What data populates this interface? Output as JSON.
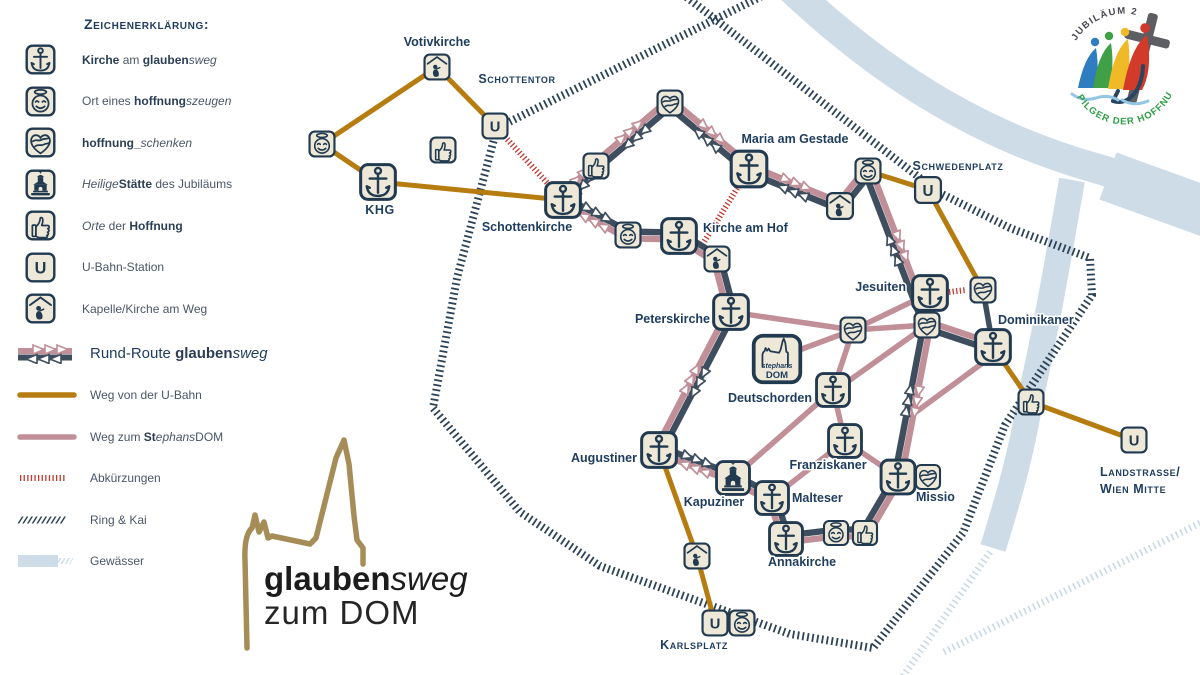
{
  "legend": {
    "title": "Zeichenerklärung:",
    "items": [
      {
        "icon": "church",
        "segs": [
          {
            "t": "Kirche",
            "b": 1
          },
          {
            "t": " am "
          },
          {
            "t": "glauben",
            "b": 1
          },
          {
            "t": "sweg",
            "i": 1
          }
        ]
      },
      {
        "icon": "face",
        "segs": [
          {
            "t": "Ort eines "
          },
          {
            "t": "hoffnung",
            "b": 1
          },
          {
            "t": "szeugen",
            "i": 1
          }
        ]
      },
      {
        "icon": "heart",
        "segs": [
          {
            "t": "hoffnung",
            "b": 1
          },
          {
            "t": "_",
            "b": 1
          },
          {
            "t": "schenken",
            "i": 1
          }
        ]
      },
      {
        "icon": "temple",
        "segs": [
          {
            "t": "Heilige",
            "i": 1
          },
          {
            "t": "Stätte",
            "b": 1
          },
          {
            "t": " des Jubiläums"
          }
        ]
      },
      {
        "icon": "thumb",
        "segs": [
          {
            "t": "Orte",
            "i": 1
          },
          {
            "t": " der "
          },
          {
            "t": "Hoffnung",
            "b": 1
          }
        ]
      },
      {
        "icon": "ubahn",
        "segs": [
          {
            "t": "U-Bahn-Station"
          }
        ]
      },
      {
        "icon": "chapel",
        "segs": [
          {
            "t": "Kapelle/Kirche am Weg"
          }
        ]
      }
    ],
    "routes": [
      {
        "sample": "rundroute",
        "big": true,
        "segs": [
          {
            "t": "Rund-Route "
          },
          {
            "t": "glauben",
            "b": 1
          },
          {
            "t": "sweg",
            "i": 1
          }
        ]
      },
      {
        "sample": "ubahnweg",
        "segs": [
          {
            "t": "Weg von der U-Bahn"
          }
        ]
      },
      {
        "sample": "domweg",
        "segs": [
          {
            "t": "Weg zum "
          },
          {
            "t": "St",
            "b": 1
          },
          {
            "t": "ephans",
            "i": 1
          },
          {
            "t": "DOM"
          }
        ]
      },
      {
        "sample": "abk",
        "segs": [
          {
            "t": "Abkürzungen"
          }
        ]
      },
      {
        "sample": "ring",
        "segs": [
          {
            "t": "Ring & Kai"
          }
        ]
      },
      {
        "sample": "wasser",
        "segs": [
          {
            "t": "Gewässer"
          }
        ]
      }
    ]
  },
  "logo": {
    "bold": "glauben",
    "italic": "sweg",
    "line2": "zum DOM"
  },
  "badge": {
    "top": "JUBILÄUM 2025",
    "bottom": "PILGER DER HOFFNUNG"
  },
  "colors": {
    "navy": "#2c4257",
    "route_navy": "#3f4e5f",
    "pink": "#c08f98",
    "ochre": "#b67c10",
    "red": "#c0392f",
    "cream": "#ede8d8",
    "water": "#cedce7",
    "water_hatch": "#c9d9e5",
    "label": "#1d3c5e",
    "gold": "#a68d58"
  },
  "map": {
    "water_bands": [
      {
        "d": "M 782 -20 C 860 55 960 130 1095 168 C 1150 184 1190 198 1222 208",
        "w": 30
      },
      {
        "d": "M 1108 176 L 1224 218",
        "w": 50
      },
      {
        "d": "M 1072 180 C 1058 260 1046 330 1030 400 C 1021 458 1004 512 993 548",
        "w": 26
      }
    ],
    "water_hatch": [
      {
        "x1": 990,
        "y1": 552,
        "x2": 903,
        "y2": 676
      },
      {
        "x1": 944,
        "y1": 652,
        "x2": 1202,
        "y2": 522
      }
    ],
    "ring": {
      "points": [
        [
          770,
          -8
        ],
        [
          497,
          128
        ],
        [
          457,
          278
        ],
        [
          433,
          408
        ],
        [
          520,
          512
        ],
        [
          600,
          566
        ],
        [
          790,
          634
        ],
        [
          873,
          648
        ],
        [
          963,
          533
        ],
        [
          1005,
          425
        ],
        [
          1092,
          295
        ],
        [
          1090,
          258
        ],
        [
          1010,
          228
        ],
        [
          938,
          192
        ],
        [
          680,
          -8
        ]
      ]
    },
    "brown": [
      {
        "a": [
          322,
          144
        ],
        "b": [
          437,
          67
        ]
      },
      {
        "a": [
          437,
          67
        ],
        "b": [
          495,
          126
        ]
      },
      {
        "a": [
          322,
          144
        ],
        "b": [
          378,
          182
        ]
      },
      {
        "a": [
          378,
          182
        ],
        "b": [
          563,
          200
        ]
      },
      {
        "a": [
          868,
          171
        ],
        "b": [
          928,
          190
        ]
      },
      {
        "a": [
          928,
          190
        ],
        "b": [
          983,
          290
        ]
      },
      {
        "a": [
          993,
          347
        ],
        "b": [
          1031,
          402
        ]
      },
      {
        "a": [
          1031,
          402
        ],
        "b": [
          1134,
          440
        ]
      },
      {
        "a": [
          659,
          450
        ],
        "b": [
          697,
          556
        ]
      },
      {
        "a": [
          697,
          556
        ],
        "b": [
          715,
          623
        ]
      }
    ],
    "dotted": [
      {
        "a": [
          495,
          126
        ],
        "b": [
          563,
          200
        ]
      },
      {
        "a": [
          741,
          182
        ],
        "b": [
          701,
          247
        ]
      },
      {
        "a": [
          949,
          292
        ],
        "b": [
          966,
          290
        ]
      }
    ],
    "pink_paths": [
      {
        "a": [
          731,
          312
        ],
        "b": [
          853,
          330
        ]
      },
      {
        "a": [
          853,
          330
        ],
        "b": [
          802,
          349
        ]
      },
      {
        "a": [
          853,
          330
        ],
        "b": [
          930,
          293
        ]
      },
      {
        "a": [
          853,
          330
        ],
        "b": [
          927,
          325
        ]
      },
      {
        "a": [
          853,
          330
        ],
        "b": [
          833,
          390
        ]
      },
      {
        "a": [
          843,
          385
        ],
        "b": [
          920,
          330
        ]
      },
      {
        "a": [
          833,
          390
        ],
        "b": [
          733,
          478
        ]
      },
      {
        "a": [
          833,
          390
        ],
        "b": [
          845,
          441
        ]
      },
      {
        "a": [
          845,
          441
        ],
        "b": [
          898,
          477
        ]
      },
      {
        "a": [
          772,
          498
        ],
        "b": [
          845,
          441
        ]
      },
      {
        "a": [
          984,
          362
        ],
        "b": [
          916,
          412
        ]
      },
      {
        "a": [
          898,
          477
        ],
        "b": [
          928,
          477
        ]
      }
    ],
    "pairs": [
      {
        "a": [
          563,
          200
        ],
        "b": [
          596,
          166
        ],
        "arrows": true
      },
      {
        "a": [
          596,
          166
        ],
        "b": [
          670,
          103
        ],
        "arrows": true
      },
      {
        "a": [
          670,
          103
        ],
        "b": [
          749,
          169
        ],
        "arrows": true
      },
      {
        "a": [
          749,
          169
        ],
        "b": [
          840,
          206
        ],
        "arrows": true
      },
      {
        "a": [
          840,
          206
        ],
        "b": [
          868,
          171
        ],
        "arrows": false
      },
      {
        "a": [
          868,
          171
        ],
        "b": [
          927,
          325
        ],
        "arrows": true
      },
      {
        "a": [
          927,
          325
        ],
        "b": [
          993,
          347
        ],
        "arrows": false
      },
      {
        "a": [
          927,
          325
        ],
        "b": [
          898,
          477
        ],
        "arrows": true
      },
      {
        "a": [
          898,
          477
        ],
        "b": [
          865,
          533
        ],
        "arrows": false
      },
      {
        "a": [
          865,
          533
        ],
        "b": [
          836,
          533
        ],
        "arrows": false
      },
      {
        "a": [
          836,
          533
        ],
        "b": [
          786,
          539
        ],
        "arrows": false
      },
      {
        "a": [
          786,
          539
        ],
        "b": [
          772,
          498
        ],
        "arrows": false
      },
      {
        "a": [
          772,
          498
        ],
        "b": [
          733,
          478
        ],
        "arrows": false
      },
      {
        "a": [
          733,
          478
        ],
        "b": [
          659,
          450
        ],
        "arrows": true
      },
      {
        "a": [
          659,
          450
        ],
        "b": [
          731,
          312
        ],
        "arrows": true
      },
      {
        "a": [
          731,
          312
        ],
        "b": [
          717,
          259
        ],
        "arrows": false
      },
      {
        "a": [
          717,
          259
        ],
        "b": [
          679,
          236
        ],
        "arrows": false
      },
      {
        "a": [
          679,
          236
        ],
        "b": [
          628,
          235
        ],
        "arrows": false
      },
      {
        "a": [
          628,
          235
        ],
        "b": [
          563,
          200
        ],
        "arrows": true
      }
    ],
    "navy_paths": [
      {
        "a": [
          983,
          290
        ],
        "b": [
          993,
          347
        ]
      }
    ],
    "icons": [
      {
        "t": "face",
        "x": 322,
        "y": 144,
        "s": 28
      },
      {
        "t": "chapel",
        "x": 437,
        "y": 67,
        "s": 28
      },
      {
        "t": "ubahn",
        "x": 495,
        "y": 126,
        "s": 28
      },
      {
        "t": "thumb",
        "x": 443,
        "y": 150,
        "s": 28
      },
      {
        "t": "church",
        "x": 378,
        "y": 182,
        "s": 39
      },
      {
        "t": "church",
        "x": 563,
        "y": 200,
        "s": 39
      },
      {
        "t": "thumb",
        "x": 596,
        "y": 166,
        "s": 28
      },
      {
        "t": "heart",
        "x": 670,
        "y": 103,
        "s": 28
      },
      {
        "t": "church",
        "x": 749,
        "y": 169,
        "s": 40
      },
      {
        "t": "face",
        "x": 628,
        "y": 235,
        "s": 28
      },
      {
        "t": "church",
        "x": 679,
        "y": 236,
        "s": 39
      },
      {
        "t": "chapel",
        "x": 717,
        "y": 259,
        "s": 28
      },
      {
        "t": "face",
        "x": 868,
        "y": 171,
        "s": 28
      },
      {
        "t": "chapel",
        "x": 840,
        "y": 206,
        "s": 29
      },
      {
        "t": "ubahn",
        "x": 928,
        "y": 190,
        "s": 29
      },
      {
        "t": "church",
        "x": 930,
        "y": 293,
        "s": 39
      },
      {
        "t": "heart",
        "x": 983,
        "y": 290,
        "s": 28
      },
      {
        "t": "heart",
        "x": 927,
        "y": 325,
        "s": 28
      },
      {
        "t": "church",
        "x": 993,
        "y": 347,
        "s": 39
      },
      {
        "t": "church",
        "x": 731,
        "y": 312,
        "s": 39
      },
      {
        "t": "heart",
        "x": 853,
        "y": 330,
        "s": 28
      },
      {
        "t": "church",
        "x": 833,
        "y": 390,
        "s": 37
      },
      {
        "t": "church",
        "x": 845,
        "y": 441,
        "s": 37
      },
      {
        "t": "church",
        "x": 659,
        "y": 450,
        "s": 39
      },
      {
        "t": "temple",
        "x": 733,
        "y": 478,
        "s": 37
      },
      {
        "t": "church",
        "x": 772,
        "y": 498,
        "s": 37
      },
      {
        "t": "church",
        "x": 786,
        "y": 539,
        "s": 37
      },
      {
        "t": "face",
        "x": 836,
        "y": 533,
        "s": 27
      },
      {
        "t": "thumb",
        "x": 865,
        "y": 533,
        "s": 27
      },
      {
        "t": "church",
        "x": 898,
        "y": 477,
        "s": 38
      },
      {
        "t": "heart",
        "x": 928,
        "y": 477,
        "s": 27
      },
      {
        "t": "chapel",
        "x": 697,
        "y": 556,
        "s": 28
      },
      {
        "t": "ubahn",
        "x": 715,
        "y": 623,
        "s": 28
      },
      {
        "t": "face",
        "x": 742,
        "y": 623,
        "s": 28
      },
      {
        "t": "thumb",
        "x": 1031,
        "y": 402,
        "s": 28
      },
      {
        "t": "ubahn",
        "x": 1134,
        "y": 440,
        "s": 28
      },
      {
        "t": "dom",
        "x": 777,
        "y": 359,
        "s": 52
      }
    ],
    "labels": [
      {
        "text": "Votivkirche",
        "x": 437,
        "y": 46,
        "kind": "place",
        "anchor": "middle"
      },
      {
        "text": "Schottentor",
        "x": 517,
        "y": 83,
        "kind": "station",
        "anchor": "middle"
      },
      {
        "text": "KHG",
        "x": 380,
        "y": 214,
        "kind": "station",
        "anchor": "middle"
      },
      {
        "text": "Schottenkirche",
        "x": 527,
        "y": 231,
        "kind": "place",
        "anchor": "middle"
      },
      {
        "text": "Maria am Gestade",
        "x": 795,
        "y": 143,
        "kind": "place",
        "anchor": "middle"
      },
      {
        "text": "Schwedenplatz",
        "x": 958,
        "y": 170,
        "kind": "station",
        "anchor": "middle"
      },
      {
        "text": "Kirche am Hof",
        "x": 703,
        "y": 232,
        "kind": "place",
        "anchor": "start"
      },
      {
        "text": "Jesuiten",
        "x": 906,
        "y": 291,
        "kind": "place",
        "anchor": "end"
      },
      {
        "text": "Dominikaner",
        "x": 998,
        "y": 324,
        "kind": "place",
        "anchor": "start"
      },
      {
        "text": "Peterskirche",
        "x": 710,
        "y": 323,
        "kind": "place",
        "anchor": "end"
      },
      {
        "text": "Deutschorden",
        "x": 812,
        "y": 402,
        "kind": "place",
        "anchor": "end"
      },
      {
        "text": "Franziskaner",
        "x": 828,
        "y": 469,
        "kind": "place",
        "anchor": "middle"
      },
      {
        "text": "Augustiner",
        "x": 637,
        "y": 462,
        "kind": "place",
        "anchor": "end"
      },
      {
        "text": "Kapuziner",
        "x": 714,
        "y": 506,
        "kind": "place",
        "anchor": "middle"
      },
      {
        "text": "Malteser",
        "x": 792,
        "y": 502,
        "kind": "place",
        "anchor": "start"
      },
      {
        "text": "Missio",
        "x": 916,
        "y": 501,
        "kind": "place",
        "anchor": "start"
      },
      {
        "text": "Annakirche",
        "x": 802,
        "y": 566,
        "kind": "place",
        "anchor": "middle"
      },
      {
        "text": "Karlsplatz",
        "x": 694,
        "y": 649,
        "kind": "station",
        "anchor": "middle"
      },
      {
        "text": "Landstrasse/",
        "x": 1100,
        "y": 476,
        "kind": "station",
        "anchor": "start"
      },
      {
        "text": "Wien Mitte",
        "x": 1100,
        "y": 493,
        "kind": "station",
        "anchor": "start"
      },
      {
        "text": "stephans",
        "x": 777,
        "y": 368,
        "kind": "domsmall",
        "anchor": "middle"
      },
      {
        "text": "DOM",
        "x": 777,
        "y": 378,
        "kind": "dombig",
        "anchor": "middle"
      }
    ]
  }
}
